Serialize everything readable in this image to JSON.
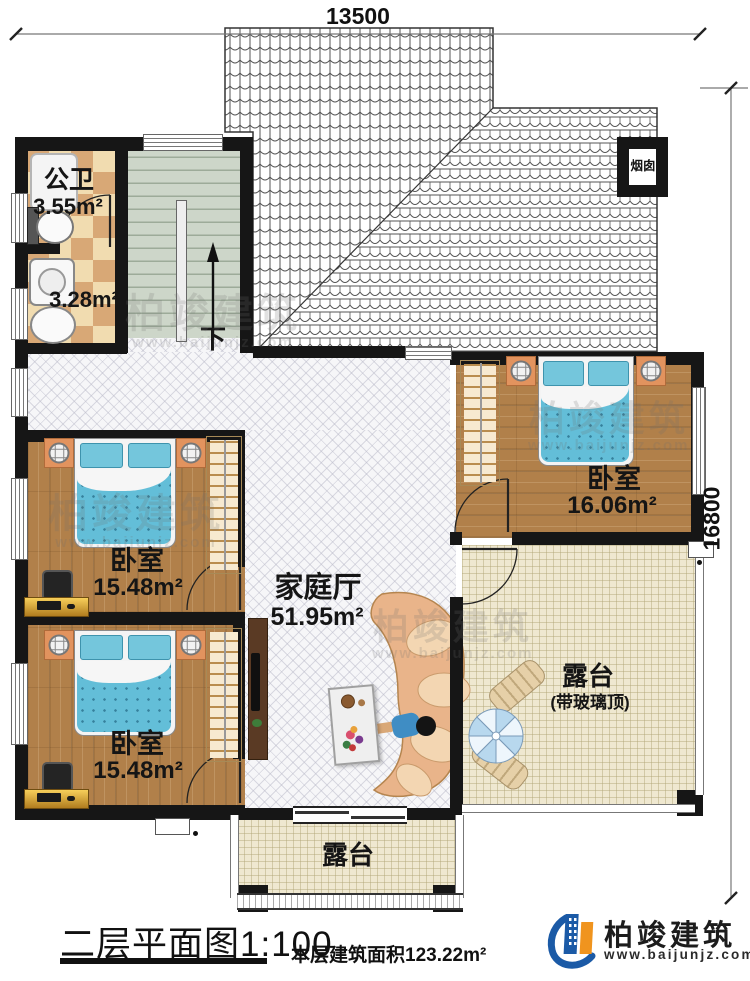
{
  "dimensions": {
    "top": "13500",
    "right": "16800"
  },
  "rooms": {
    "public_bath": {
      "label": "公卫",
      "area": "3.55m²"
    },
    "laundry": {
      "area": "3.28m²"
    },
    "bedroom_right": {
      "label": "卧室",
      "area": "16.06m²"
    },
    "bedroom_mid": {
      "label": "卧室",
      "area": "15.48m²"
    },
    "bedroom_bottom": {
      "label": "卧室",
      "area": "15.48m²"
    },
    "family_hall": {
      "label": "家庭厅",
      "area": "51.95m²"
    },
    "terrace_right": {
      "label": "露台",
      "note": "(带玻璃顶)"
    },
    "terrace_bottom": {
      "label": "露台"
    }
  },
  "annotations": {
    "chimney": "烟囱",
    "stair_down": "下"
  },
  "footer": {
    "plan_title": "二层平面图1:100",
    "area_note": "本层建筑面积123.22m²"
  },
  "brand": {
    "name": "柏竣建筑",
    "website": "www.baijunjz.com"
  },
  "watermark": {
    "name": "柏竣建筑",
    "website": "www.baijunjz.com"
  },
  "colors": {
    "wall": "#161616",
    "brand_blue": "#1b5aa6",
    "brand_orange": "#f0941e",
    "bed_blue": "#63bed8",
    "wood": "#b1804a",
    "stair": "#cdd6c9",
    "tile_light": "#f1dcb0",
    "tile_dark": "#d8a876",
    "terrace": "#efe8d0"
  }
}
